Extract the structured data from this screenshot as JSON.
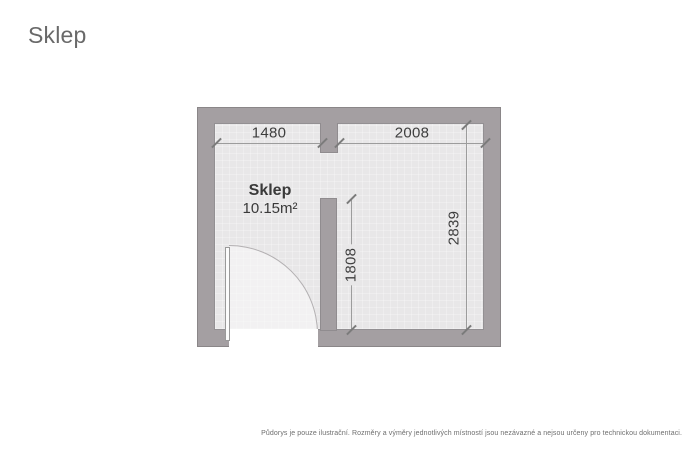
{
  "page": {
    "title": "Sklep"
  },
  "floorplan": {
    "room": {
      "name": "Sklep",
      "area": "10.15m²"
    },
    "dimensions": {
      "top_left_width": "1480",
      "top_right_width": "2008",
      "right_height": "2839",
      "inner_height": "1808"
    },
    "colors": {
      "wall": "#a49fa2",
      "wall_outline": "#8a8688",
      "floor": "#e8e7e8",
      "dim_line": "#9c9c9c",
      "dim_text": "#3e3e3e",
      "title_text": "#696969"
    }
  },
  "footer": {
    "disclaimer": "Půdorys je pouze ilustrační. Rozměry a výměry jednotlivých místností jsou nezávazné a nejsou určeny pro technickou dokumentaci."
  }
}
